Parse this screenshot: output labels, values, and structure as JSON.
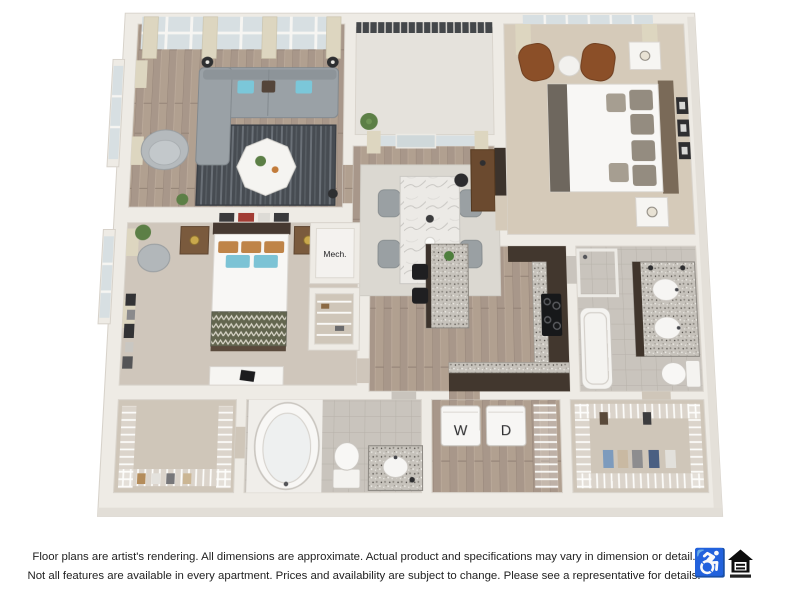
{
  "page": {
    "background_color": "#ffffff"
  },
  "floor_plan": {
    "type": "3d-apartment-floor-plan-rendering",
    "labels": {
      "mech": "Mech.",
      "washer": "W",
      "dryer": "D"
    },
    "rooms": [
      "living room",
      "balcony",
      "dining area",
      "bedroom 2",
      "master bedroom",
      "kitchen",
      "bathroom 2",
      "master bathroom",
      "walk-in closet 1",
      "laundry closet",
      "walk-in closet 2",
      "mechanical closet",
      "linen closet"
    ],
    "colors": {
      "wall": "#eeebe5",
      "wood_floor": "#b1a090",
      "carpet": "#d5cab9",
      "tile": "#c9c4bd",
      "cabinet_dark_brown": "#42372e",
      "sofa_gray": "#9aa1a6",
      "accent_pillow_blue": "#7bc7d9",
      "leather_chair_brown": "#8b4f28",
      "railing_dark": "#44474a",
      "rug_dark": "#474c52",
      "granite": "#c6c2bb"
    }
  },
  "disclaimer": {
    "line1": "Floor plans are artist's rendering. All dimensions are approximate. Actual product and specifications may vary in dimension or detail.",
    "line2": "Not all features are available in every apartment. Prices and availability are subject to change. Please see a representative for details."
  },
  "icons": {
    "accessibility_glyph": "♿",
    "equal_housing": "equal-housing-opportunity-logo"
  }
}
